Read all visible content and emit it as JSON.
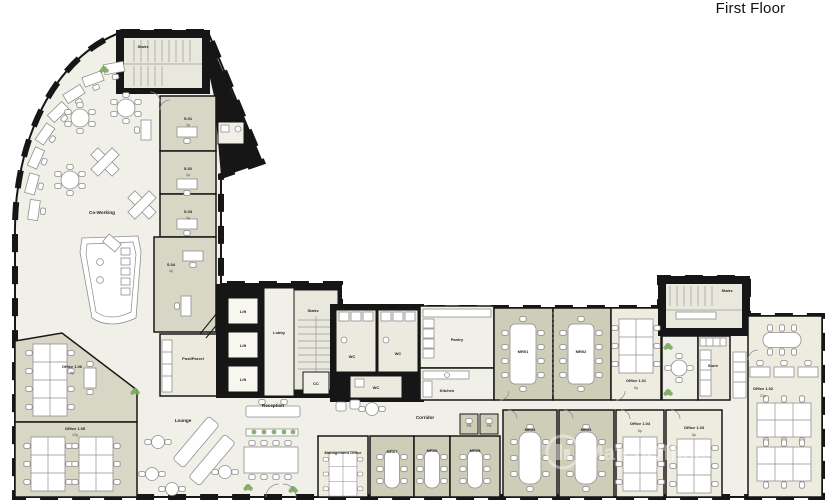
{
  "title": "First Floor",
  "watermark": "MatchOffice",
  "colors": {
    "wall": "#161616",
    "floor_open": "#f1f0e8",
    "floor_mid": "#eceade",
    "floor_office": "#edecdf",
    "floor_shaded_office": "#d8d6c4",
    "floor_meeting": "#cecdb8",
    "stair_fill": "#e9e8dd",
    "plant_green": "#79a860",
    "label_color": "#222222"
  },
  "rooms": {
    "stairs_nw": {
      "label": "Stairs"
    },
    "coworking": {
      "label": "Co-Working"
    },
    "s01": {
      "label": "S.01",
      "cap": "1p"
    },
    "s02": {
      "label": "S.02",
      "cap": "1p"
    },
    "s03": {
      "label": "S.03",
      "cap": "1p"
    },
    "s04": {
      "label": "S.04",
      "cap": "1p"
    },
    "office_1_06": {
      "label": "Office 1.06",
      "cap": "9p"
    },
    "office_1_05": {
      "label": "Office 1.05",
      "cap": "12p"
    },
    "post_parcel": {
      "label": "Post/Parcel"
    },
    "lift_1": {
      "label": "Lift"
    },
    "lift_2": {
      "label": "Lift"
    },
    "lift_3": {
      "label": "Lift"
    },
    "lobby": {
      "label": "Lobby"
    },
    "stairs_core": {
      "label": "Stairs"
    },
    "cc": {
      "label": "CC"
    },
    "wc_1": {
      "label": "WC"
    },
    "wc_2": {
      "label": "WC"
    },
    "wc_3": {
      "label": "WC"
    },
    "pantry": {
      "label": "Pantry"
    },
    "kitchen": {
      "label": "Kitchen"
    },
    "lounge": {
      "label": "Lounge"
    },
    "reception": {
      "label": "Reception"
    },
    "corridor": {
      "label": "Corridor"
    },
    "management_office": {
      "label": "Management Office"
    },
    "mr07": {
      "label": "MR07"
    },
    "mr06": {
      "label": "MR06"
    },
    "mr05": {
      "label": "MR05"
    },
    "mr04": {
      "label": "MR04"
    },
    "mr03": {
      "label": "MR03"
    },
    "mr02": {
      "label": "MR02"
    },
    "mr01": {
      "label": "MR01"
    },
    "pb_1": {
      "label": "PB"
    },
    "pb_2": {
      "label": "PB"
    },
    "office_1_01": {
      "label": "Office 1.01",
      "cap": "6p"
    },
    "office_1_02": {
      "label": "Office 1.02",
      "cap": "21p"
    },
    "office_1_03": {
      "label": "Office 1.03",
      "cap": "6p"
    },
    "office_1_04": {
      "label": "Office 1.04",
      "cap": "6p"
    },
    "store": {
      "label": "Store"
    },
    "stairs_ne": {
      "label": "Stairs"
    }
  }
}
